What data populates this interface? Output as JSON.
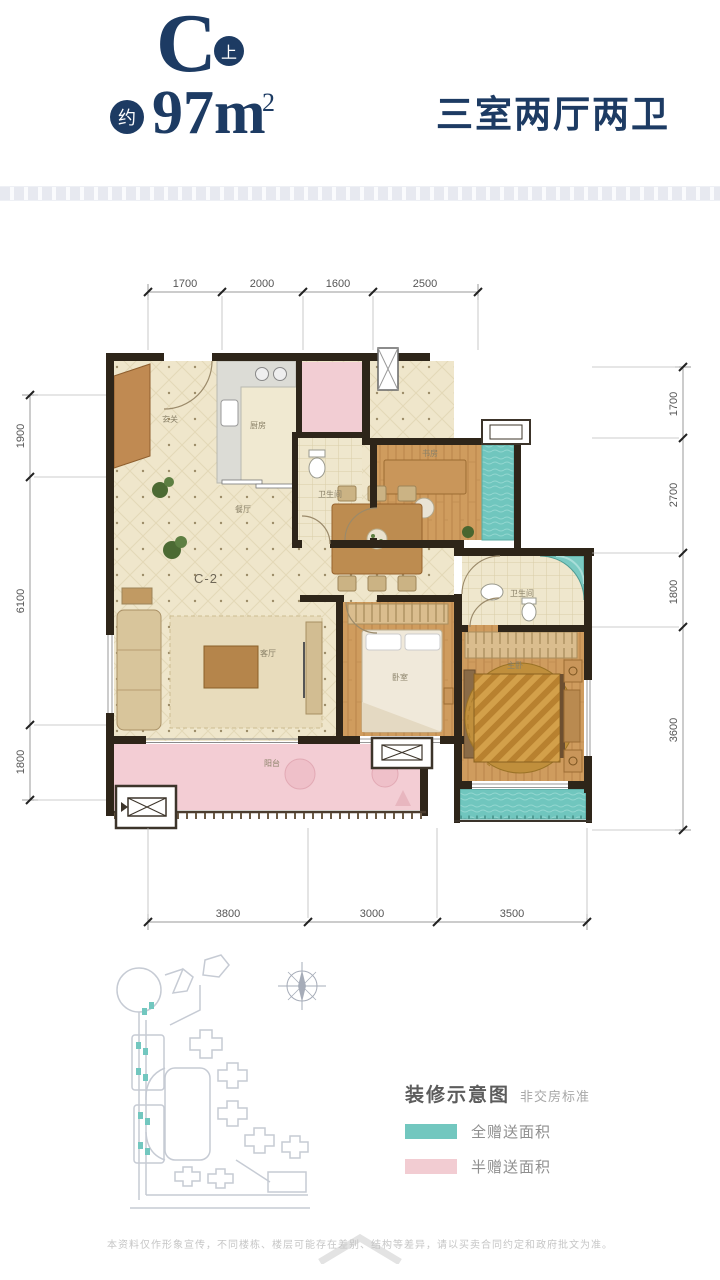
{
  "header": {
    "unit_letter": "C",
    "unit_badge": "上",
    "area_prefix_badge": "约",
    "area_value": "97m",
    "area_superscript": "2",
    "layout_description": "三室两厅两卫"
  },
  "floor_plan": {
    "unit_label": "C-2",
    "dimensions": {
      "top": [
        "1700",
        "2000",
        "1600",
        "2500"
      ],
      "left": [
        "1900",
        "6100",
        "1800"
      ],
      "right": [
        "1700",
        "2700",
        "1800",
        "3600"
      ],
      "bottom": [
        "3800",
        "3000",
        "3500"
      ]
    },
    "rooms": {
      "entry": "玄关",
      "kitchen": "厨房",
      "bathroom": "卫生间",
      "study": "书房",
      "dining": "餐厅",
      "living": "客厅",
      "bedroom": "卧室",
      "master_bathroom": "卫生间",
      "master_bedroom": "主卧",
      "balcony": "阳台"
    }
  },
  "legend": {
    "title": "装修示意图",
    "subtitle": "非交房标准",
    "items": [
      {
        "label": "全赠送面积",
        "color": "#72c7bf"
      },
      {
        "label": "半赠送面积",
        "color": "#f2ccd2"
      }
    ]
  },
  "footer": {
    "disclaimer": "本资料仅作形象宣传，不同楼栋、楼层可能存在差别、结构等差异，请以买卖合同约定和政府批文为准。"
  },
  "colors": {
    "accent_navy": "#1d3b63",
    "full_gift_teal": "#72c7bf",
    "half_gift_pink": "#f2ccd2"
  }
}
